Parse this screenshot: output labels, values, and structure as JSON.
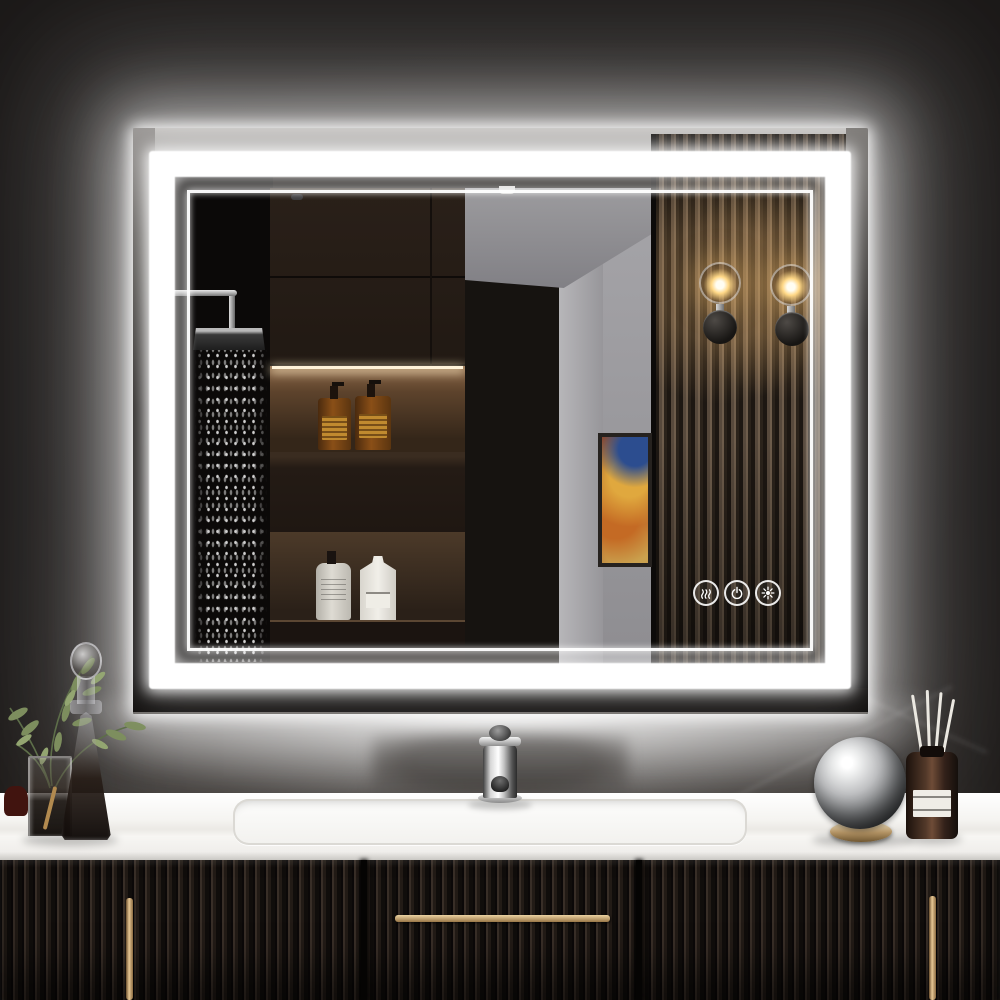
{
  "scene": {
    "label": "Product photo of an LED backlit bathroom vanity mirror over a dark fluted vanity cabinet",
    "wall": {
      "label": "dark wall with white backlight glow",
      "base_color": "#343130",
      "glow_color": "#ffffff"
    },
    "mirror": {
      "label": "rectangular front-lit and backlit LED mirror",
      "led_band_color": "#ffffff",
      "frame_style": "double light band (thick outer band + thin inner line)"
    },
    "controls": {
      "label": "mirror touch controls",
      "buttons": [
        {
          "name": "defogger",
          "icon": "defog-icon"
        },
        {
          "name": "power-dimmer",
          "icon": "power-icon"
        },
        {
          "name": "color-temperature",
          "icon": "color-temp-icon"
        }
      ]
    },
    "reflection": {
      "label": "bathroom reflection in mirror",
      "items": [
        "rain shower head with falling water spray",
        "dark wood cabinets and lit shelf niches",
        "two amber pump soap bottles with orange labels",
        "white round pump bottle and white square bottle",
        "gray hallway wall with abstract orange-blue artwork",
        "vertical slatted wood accent wall",
        "two glass globe wall sconces with warm bulbs"
      ]
    },
    "vanity": {
      "counter_label": "white countertop with undermount sink",
      "counter_color": "#f5f4f1",
      "fixture": "chrome single-handle faucet",
      "cabinet_label": "dark fluted cabinet with brass handles",
      "cabinet_color": "#1a1512",
      "handle_color": "#c29962",
      "items_left": [
        "olive branch sprigs in square glass vase",
        "glass decanter with ball stopper"
      ],
      "items_right": [
        "chrome sphere ornament on brass ring",
        "reed diffuser bottle with white reeds"
      ]
    }
  }
}
